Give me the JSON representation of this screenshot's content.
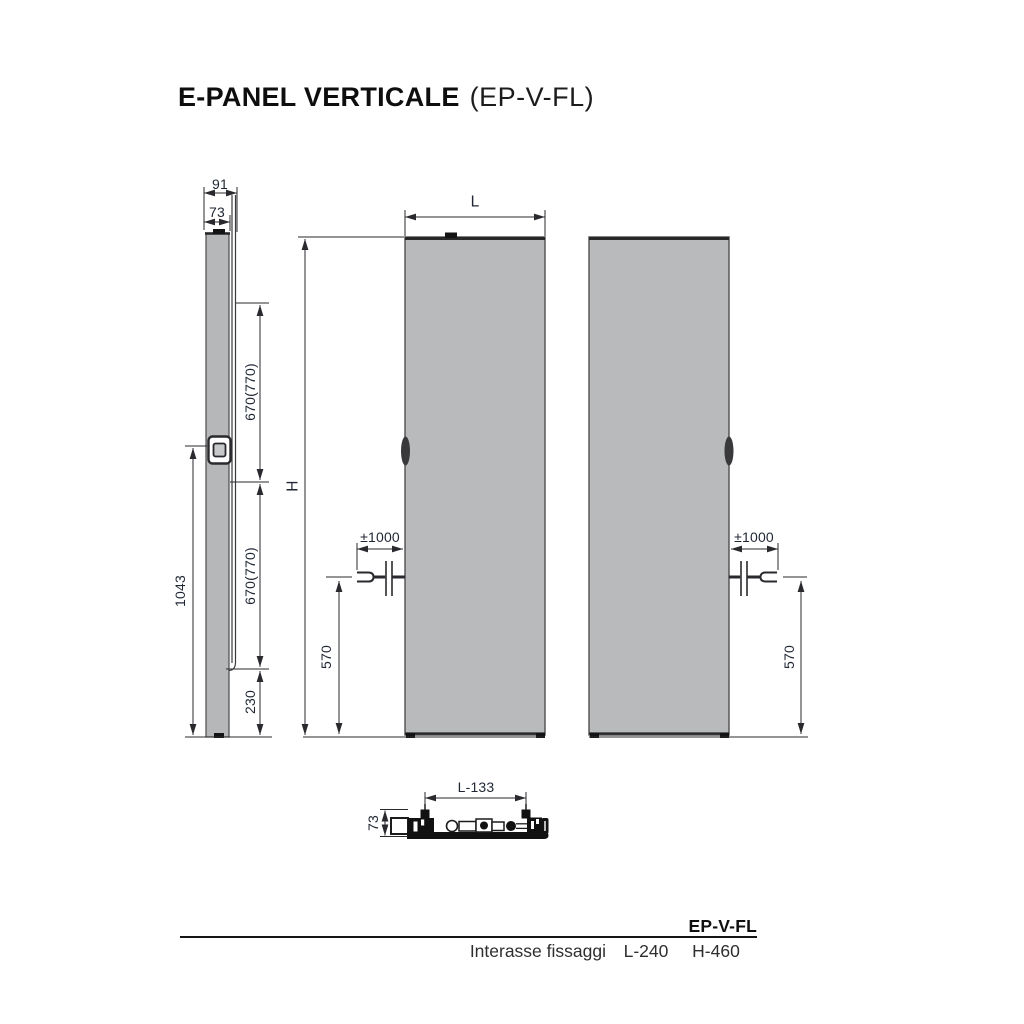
{
  "title": {
    "main": "E-PANEL VERTICALE",
    "code": "(EP-V-FL)"
  },
  "side_view": {
    "dim_depth_total": "91",
    "dim_depth_panel": "73",
    "dim_upper_spacing": "670(770)",
    "dim_lower_spacing": "670(770)",
    "dim_bottom_offset": "230",
    "dim_fixing_height": "1043"
  },
  "front_view_left": {
    "dim_width": "L",
    "dim_height": "H",
    "dim_cable_length": "±1000",
    "dim_cable_height": "570"
  },
  "front_view_right": {
    "dim_cable_length": "±1000",
    "dim_cable_height": "570"
  },
  "top_view": {
    "dim_bracket_spacing": "L-133",
    "dim_depth": "73"
  },
  "footer": {
    "model": "EP-V-FL",
    "row_label": "Interasse fissaggi",
    "value_l": "L-240",
    "value_h": "H-460"
  },
  "colors": {
    "panel_fill": "#b9babc",
    "panel_edge": "#4a4a4c",
    "line": "#2a2a2e",
    "dim_text": "#1f2633"
  }
}
